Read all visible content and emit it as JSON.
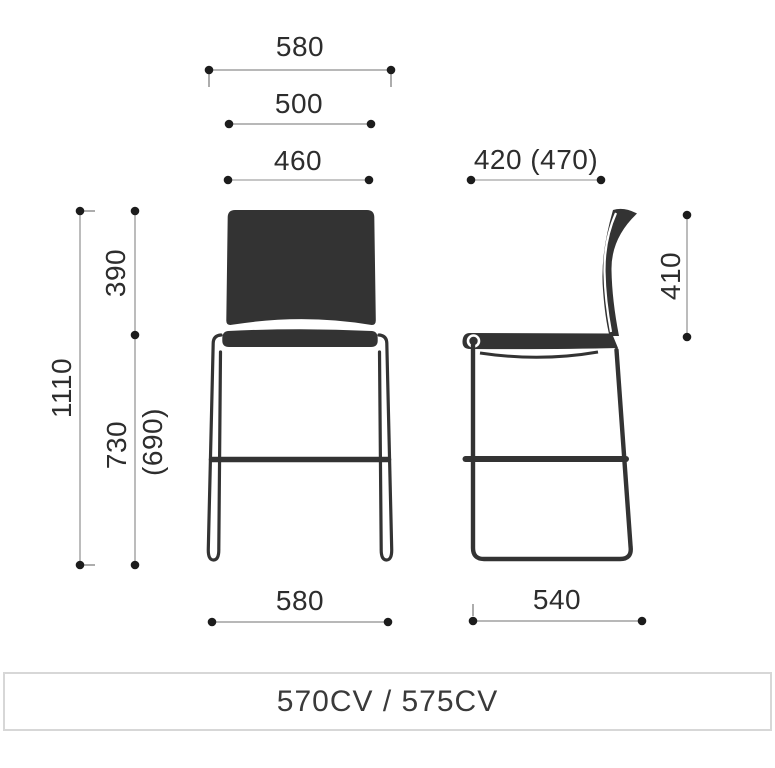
{
  "colors": {
    "chair_fill": "#333333",
    "dimension_text": "#2d2d2d",
    "dimension_line": "#a0a0a0",
    "dimension_dot": "#1c1c1c",
    "footer_border": "#d7d7d7",
    "footer_text": "#3a3a3a"
  },
  "front_view": {
    "name": "bar stool front view",
    "dims": {
      "overall_width": "580",
      "seat_width": "500",
      "inner_width": "460",
      "backrest_height": "390",
      "overall_height": "1110",
      "seat_height": "730",
      "seat_height_alt": "(690)",
      "base_width": "580"
    }
  },
  "side_view": {
    "name": "bar stool side view",
    "dims": {
      "seat_depth": "420 (470)",
      "backrest_height": "410",
      "base_depth": "540"
    }
  },
  "footer": {
    "label": "570CV / 575CV"
  }
}
